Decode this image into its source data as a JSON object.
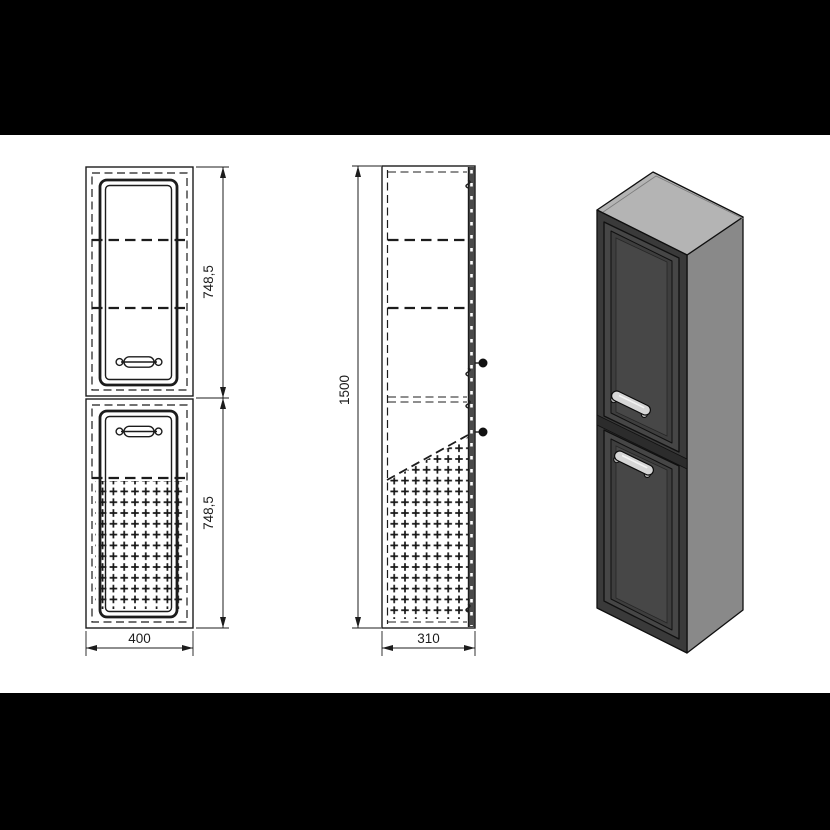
{
  "drawing": {
    "product": "tall two-door cabinet technical drawing",
    "dimensions": {
      "upper_section_height_mm": "748,5",
      "lower_section_height_mm": "748,5",
      "total_height_mm": "1500",
      "width_mm": "400",
      "depth_mm": "310"
    },
    "colors": {
      "letterbox": "#000000",
      "paper": "#ffffff",
      "line": "#1c1c1c",
      "iso_top_face": "#b4b4b4",
      "iso_side_face": "#898989",
      "iso_front_face": "#3a3a3a",
      "iso_door_face": "#464646",
      "iso_door_panel": "#3e3e3e",
      "iso_panel_center": "#474747",
      "iso_handle": "#d6d6d6"
    }
  }
}
